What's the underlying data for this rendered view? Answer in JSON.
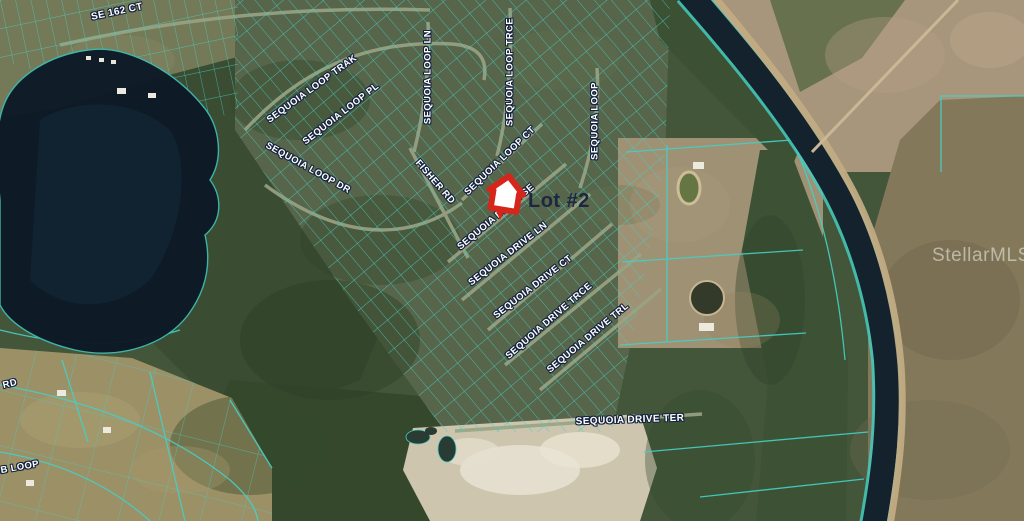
{
  "map": {
    "description": "Aerial parcel map of Sequoia subdivision with MLS listing pin",
    "watermark": "StellarMLS",
    "marker": {
      "type": "red-house-pin",
      "color": "#d6261c",
      "label": "Lot #2"
    },
    "street_labels": [
      {
        "text": "SE 162 CT",
        "x": 117,
        "y": 12,
        "rot": -12,
        "size": 10
      },
      {
        "text": "SEQUOIA LOOP TRAK",
        "x": 312,
        "y": 89,
        "rot": -36
      },
      {
        "text": "SEQUOIA LOOP PL",
        "x": 341,
        "y": 114,
        "rot": -38
      },
      {
        "text": "SEQUOIA LOOP DR",
        "x": 308,
        "y": 168,
        "rot": 29
      },
      {
        "text": "SEQUOIA LOOP LN",
        "x": 428,
        "y": 77,
        "rot": -90
      },
      {
        "text": "SEQUOIA LOOP TRCE",
        "x": 510,
        "y": 72,
        "rot": -90
      },
      {
        "text": "SEQUOIA LOOP",
        "x": 595,
        "y": 121,
        "rot": -90
      },
      {
        "text": "SEQUOIA LOOP CT",
        "x": 500,
        "y": 161,
        "rot": -44
      },
      {
        "text": "FISHER RD",
        "x": 435,
        "y": 182,
        "rot": 49
      },
      {
        "text": "SEQUOIA DRIVE SE",
        "x": 496,
        "y": 217,
        "rot": -40
      },
      {
        "text": "SEQUOIA DRIVE LN",
        "x": 508,
        "y": 254,
        "rot": -38
      },
      {
        "text": "SEQUOIA DRIVE CT",
        "x": 533,
        "y": 287,
        "rot": -38
      },
      {
        "text": "SEQUOIA DRIVE TRCE",
        "x": 549,
        "y": 321,
        "rot": -41
      },
      {
        "text": "SEQUOIA DRIVE TRL",
        "x": 588,
        "y": 338,
        "rot": -40
      },
      {
        "text": "SEQUOIA DRIVE TER",
        "x": 630,
        "y": 420,
        "rot": -2,
        "size": 10
      },
      {
        "text": "RD",
        "x": 10,
        "y": 384,
        "rot": -14
      },
      {
        "text": "OB LOOP",
        "x": 16,
        "y": 468,
        "rot": -10
      }
    ],
    "colors": {
      "parcel_line": "#46cfc5",
      "label_text": "#ffffff",
      "label_outline": "#16233f",
      "lot_label_text": "#1d2742",
      "lake_water": "#0d1926",
      "canal_water": "#13222c",
      "marker_red": "#d6261c",
      "watermark_text": "#f2f1e9"
    }
  }
}
